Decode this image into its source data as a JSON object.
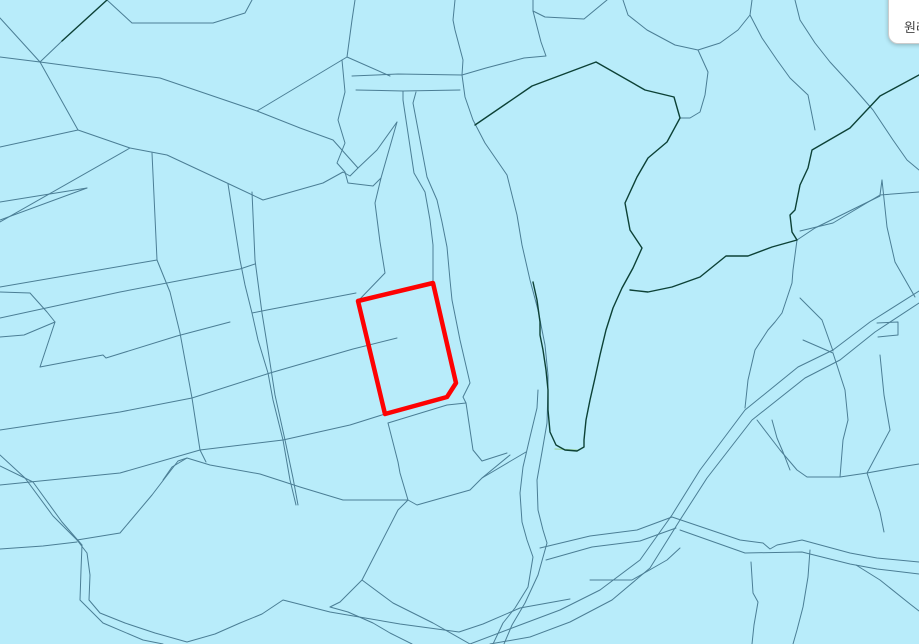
{
  "toolbar": {
    "reset_label": "원래"
  },
  "map": {
    "background": "#b8ecfa",
    "stroke_thin": {
      "color": "#4b7e95",
      "width": 1
    },
    "stroke_dark": {
      "color": "#0c4136",
      "width": 1.4
    },
    "stroke_pale": {
      "color": "#9fd6a4",
      "width": 1.2
    },
    "highlight": {
      "color": "#fe0202",
      "width": 4.5,
      "points": "358,301 433,283 456,383 447,397 385,414"
    },
    "thin_lines": [
      "252,0 245,13 213,23 132,23 107,0",
      "0,18 40,62",
      "0,57 40,62",
      "62,41 40,62",
      "40,62 160,78 257,111",
      "257,111 347,57 390,76",
      "347,57 352,20 355,0",
      "40,62 78,130 130,148 167,155 227,183 263,200 323,183 343,172 350,176 358,168 377,150 397,122",
      "0,147 78,130",
      "0,222 130,148",
      "0,202 87,188",
      "0,220 87,188",
      "257,111 300,128 333,140 358,168",
      "342,60 345,92 338,120 345,143 337,163 345,172 348,183 373,186 381,178 397,122",
      "381,178 375,203 380,242 385,273 358,301",
      "252,313 267,310 356,293",
      "0,287 157,260",
      "0,318 120,292 240,269 255,264",
      "0,430 120,412 192,398 270,373 353,349 397,338",
      "0,485 120,473 200,450 283,440 350,425 385,414",
      "152,153 157,260 170,292 180,333 192,398 200,450 206,462",
      "228,184 240,260 245,285 252,313 258,340 268,373 273,400 283,440 290,480 296,505",
      "252,192 255,260 262,313 268,350 275,395 285,440 293,478 298,505",
      "388,423 447,405 466,403",
      "388,423 398,462 400,473 408,500",
      "77,540 120,533 152,495 178,461 187,458 210,465 260,474 300,487 343,500 393,500 408,500 417,505 424,503 470,490 482,478 510,455",
      "163,480 172,467 187,458",
      "466,403 473,450 482,461 507,453",
      "482,478 509,462 526,452",
      "408,500 398,510 362,580 340,602 330,607",
      "55,322 40,367",
      "40,367 103,355 106,358 177,336 230,322",
      "0,337 24,335 55,322",
      "0,292 30,293 47,312 55,322",
      "0,549 43,546 77,542",
      "0,455 25,478 53,516 77,540",
      "0,466 33,482 62,522 82,545",
      "77,540 87,553 90,575 89,600 100,613 125,623 155,633 187,642 215,634 240,623 262,614 283,600 330,612 400,624 459,632 483,624 520,608 570,599",
      "82,545 81,570 80,600 103,623 143,640 163,644",
      "362,580 393,603 433,623 470,644",
      "330,607 348,612 373,623 390,633 412,644",
      "352,76 398,74 462,75",
      "356,90 403,91 460,90",
      "403,91 403,100 414,173 425,192 430,220 433,245 433,258 433,283",
      "416,92 413,103 427,177 437,200 442,222 447,247 450,280 452,300 460,340 470,383 463,397 466,403",
      "462,75 465,97 473,120 485,143 507,175 517,215 522,245 530,280 538,310 545,345 548,375 548,390",
      "455,0 453,20 455,30 463,60 462,75",
      "607,0 584,19 545,17 533,11 533,0",
      "533,11 541,42 546,56 524,58 486,68 462,75",
      "623,0 628,15 647,30 675,45 698,50 720,43 738,30 750,15 752,0",
      "698,50 708,72 705,95 700,112 690,118 680,118",
      "750,15 762,38 777,60 790,78 808,95 815,130",
      "795,0 800,20 815,43 830,62 853,87 873,110 893,140 907,160 919,170",
      "880,195 919,192",
      "882,180 880,195",
      "880,195 833,223 800,231",
      "882,180 887,227 895,262 915,297",
      "797,240 815,228 880,196",
      "797,240 793,270 792,283 782,313 775,322 768,330 755,350 748,380 745,408",
      "800,298 822,320 833,351",
      "803,340 833,353",
      "833,353 845,390 848,420",
      "757,420 780,450 797,470 807,477 840,477 867,473",
      "867,473 880,512 884,532",
      "867,473 900,467 919,464",
      "848,420 843,440 840,477",
      "880,355 884,395 890,430 867,473",
      "877,323 898,322 898,335 878,337",
      "919,291 870,322 833,350 798,367 745,410 700,470 672,515 640,560 600,590 560,610 520,625 470,644",
      "919,303 875,332 840,360 805,378 752,420 707,478 680,520 650,568 612,600 570,622 530,637 490,644",
      "540,548 590,536 637,530 672,517",
      "546,560 592,547 640,541 676,528",
      "672,517 740,540 763,543 770,549 777,545 802,540 850,553 877,558 919,562",
      "680,530 745,553 802,552 850,564 877,569 919,574",
      "538,390 537,408 530,437 523,467 520,493 522,522 527,540 533,557 528,587 515,608 503,623 493,644",
      "548,390 547,423 542,452 537,480 538,510 543,530 547,543 538,575 525,603 512,625 504,644",
      "590,580 632,580 667,560 680,548",
      "810,550 808,577 803,607 797,630 793,644",
      "751,562 753,593 758,602 754,625 752,644",
      "856,565 880,580 910,604 919,611",
      "772,420 777,438 783,452 790,470"
    ],
    "dark_lines": [
      "107,0 62,41",
      "475,125 532,86 596,62 645,90 674,97 680,118 667,142 648,158 637,177 625,203 630,230 642,248 633,268 622,288 613,308 606,330 600,355 595,378 590,400 586,420 584,440 584,447 577,451 565,450 556,445 550,432 548,410 548,390 546,370 543,350 540,335 540,322 537,300 533,282",
      "919,75 880,96 850,128 812,150 808,168 800,185 795,210 790,215 792,232 797,240 772,247 748,256 726,256 700,277 672,287 648,292 630,290",
      "901,12 919,30"
    ],
    "pale_lines": [
      "555,449 577,450"
    ]
  }
}
